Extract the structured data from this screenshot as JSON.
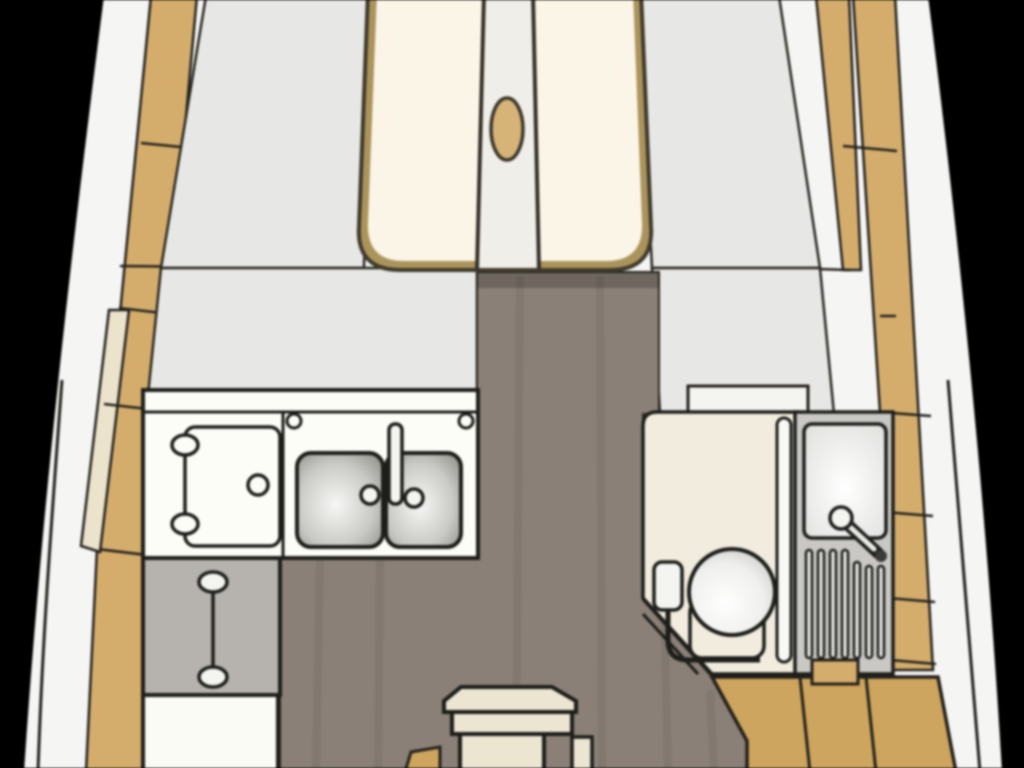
{
  "diagram": {
    "type": "sailboat-interior-floor-plan",
    "view": "overhead-bow-up",
    "palette": {
      "background": "#000000",
      "hull": "#f5f5f3",
      "outline": "#1d1d1a",
      "line_soft": "#23211e",
      "deck_wood": "#d4ad6c",
      "deck_wood_aft": "#cda55e",
      "trim_cream": "#ece3cc",
      "panel_gray": "#e7e7e5",
      "berth_border": "#ab945c",
      "berth_border_dark": "#3f3a2c",
      "berth_cushion": "#fbf5e8",
      "berth_insert": "#f0eee8",
      "hatch_oval": "#d6b478",
      "sole_floor": "#8a8077",
      "sole_shadow": "rgba(0,0,0,0.20)",
      "counter_white": "#fdfdf8",
      "fixture_white": "#f4f4f1",
      "basin_rim": "#83837d",
      "basin_light": "#f7f7f5",
      "cabinet_gray": "#b6b3ae",
      "cabinet_white": "#fbfbf5",
      "head_floor": "#f2ecdf",
      "head_panel": "#c9c8c4",
      "grate_slat": "#e2e2de",
      "bowl_light": "#ffffff",
      "bowl_shade": "#c6c6c2",
      "door_leaf": "#f8f8f5",
      "steps_cream": "#ece5d2",
      "handle_dark": "#3a3a36",
      "shelf_white": "#f4f4f1"
    },
    "regions": [
      {
        "name": "hull-band",
        "description": "white hull outline widening aft"
      },
      {
        "name": "port-side-deck",
        "seam_count": 4
      },
      {
        "name": "starboard-side-deck",
        "seam_count": 4
      },
      {
        "name": "v-berth",
        "cushion_count": 2,
        "has_center_insert": true,
        "has_hatch_oval": true
      },
      {
        "name": "forward-shelf-port"
      },
      {
        "name": "forward-shelf-starboard"
      },
      {
        "name": "saloon-sole"
      },
      {
        "name": "galley",
        "stove_gimbal_count": 2,
        "stove_knob_count": 1,
        "sink_basin_count": 2,
        "sink_tap_count": 2,
        "counter_fitting_count": 2
      },
      {
        "name": "galley-storage-cabinet"
      },
      {
        "name": "galley-lower-locker"
      },
      {
        "name": "head",
        "has_toilet": true,
        "has_washbasin": true,
        "shower_grate_slat_count": 7,
        "has_door": true
      },
      {
        "name": "head-side-lockers",
        "seam_count": 3
      },
      {
        "name": "aft-sole-teak",
        "seam_count": 2
      },
      {
        "name": "companionway-steps",
        "step_count": 3
      }
    ]
  }
}
